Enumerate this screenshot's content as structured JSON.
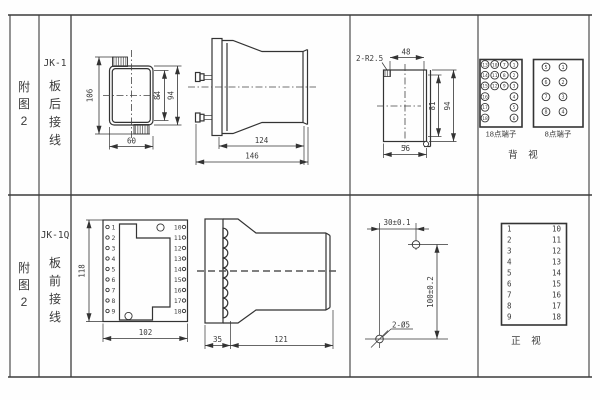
{
  "colors": {
    "line": "#333333",
    "background": "#fefefe"
  },
  "doc": {
    "row1": {
      "fig": [
        "附",
        "图",
        "2"
      ],
      "model": "JK-1",
      "wiring": [
        "板",
        "后",
        "接",
        "线"
      ]
    },
    "row2": {
      "fig": [
        "附",
        "图",
        "2"
      ],
      "model": "JK-1Q",
      "wiring": [
        "板",
        "前",
        "接",
        "线"
      ]
    }
  },
  "jk1": {
    "rear": {
      "h106": "106",
      "h84": "84",
      "h94": "94",
      "w60": "60"
    },
    "side": {
      "d124": "124",
      "d146": "146"
    },
    "cutout": {
      "note": "2-R2.5",
      "w48": "48",
      "h81": "81",
      "h94": "94",
      "w56": "56"
    },
    "back_view": {
      "t18": {
        "label": "18点端子",
        "col1": [
          "13",
          "14",
          "15",
          "16",
          "17",
          "18"
        ],
        "col2": [
          "10",
          "11",
          "12"
        ],
        "col3": [
          "7",
          "8",
          "9"
        ],
        "col4": [
          "1",
          "2",
          "3",
          "4",
          "5",
          "6"
        ]
      },
      "t8": {
        "label": "8点端子",
        "left": [
          "5",
          "6",
          "7",
          "8"
        ],
        "right": [
          "1",
          "2",
          "3",
          "4"
        ]
      },
      "view": "背 视"
    }
  },
  "jk1q": {
    "front": {
      "h118": "118",
      "w102": "102",
      "left": [
        "1",
        "2",
        "3",
        "4",
        "5",
        "6",
        "7",
        "8",
        "9"
      ],
      "right": [
        "10",
        "11",
        "12",
        "13",
        "14",
        "15",
        "16",
        "17",
        "18"
      ]
    },
    "side": {
      "w35": "35",
      "w121": "121"
    },
    "drill": {
      "w30": "30±0.1",
      "h100": "100±0.2",
      "note": "2-Ø5"
    },
    "front_table": {
      "left": [
        "1",
        "2",
        "3",
        "4",
        "5",
        "6",
        "7",
        "8",
        "9"
      ],
      "right": [
        "10",
        "11",
        "12",
        "13",
        "14",
        "15",
        "16",
        "17",
        "18"
      ],
      "view": "正 视"
    }
  }
}
